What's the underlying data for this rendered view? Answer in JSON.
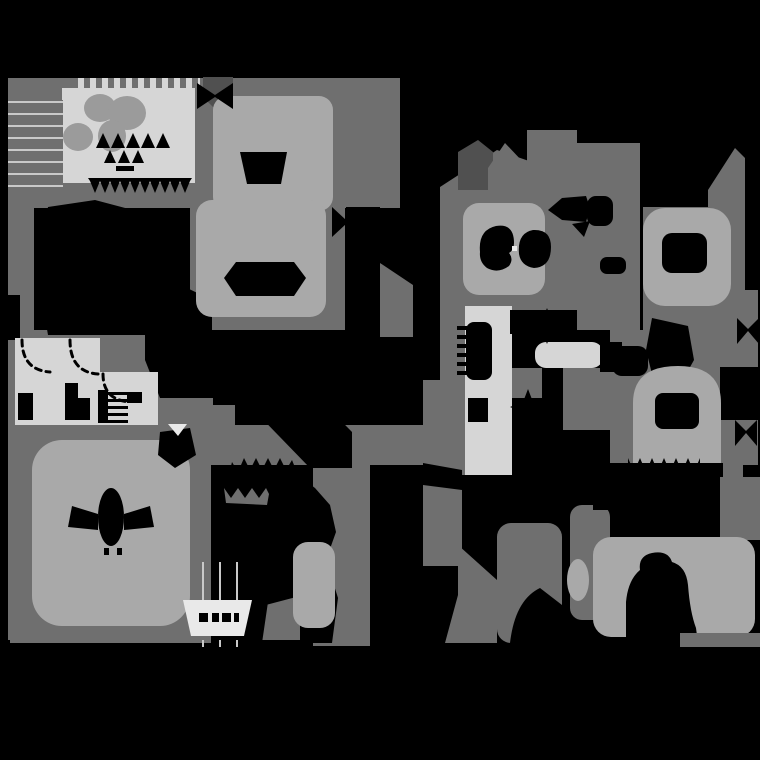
{
  "meta": {
    "description": "grayscale-terrain-map",
    "width": 760,
    "height": 760
  },
  "palette": {
    "black": "#000000",
    "dark": "#505050",
    "mid": "#6f6f6f",
    "mid2": "#9b9b9b",
    "light": "#a9a9a9",
    "room": "#d6d6d6",
    "white": "#e9e9e9",
    "line": "#c9c9c9",
    "none": "none"
  },
  "shapes": [
    {
      "n": "tl-backdrop",
      "t": "rect",
      "f": "mid",
      "x": 8,
      "y": 78,
      "w": 204,
      "h": 130
    },
    {
      "n": "left-column",
      "t": "rect",
      "f": "mid",
      "x": 8,
      "y": 95,
      "w": 26,
      "h": 545
    },
    {
      "n": "rooms-backdrop",
      "t": "rect",
      "f": "mid",
      "x": 8,
      "y": 330,
      "w": 205,
      "h": 100
    },
    {
      "n": "wedge-under-rooms",
      "t": "rect",
      "f": "mid",
      "x": 195,
      "y": 405,
      "w": 40,
      "h": 25
    },
    {
      "n": "bl-backdrop",
      "t": "rect",
      "f": "mid",
      "x": 10,
      "y": 425,
      "w": 201,
      "h": 218
    },
    {
      "n": "topcenter-backdrop",
      "t": "rect",
      "f": "mid",
      "x": 190,
      "y": 78,
      "w": 155,
      "h": 252
    },
    {
      "n": "topcenter-right",
      "t": "rect",
      "f": "mid",
      "x": 345,
      "y": 78,
      "w": 55,
      "h": 130
    },
    {
      "n": "right-wedge",
      "t": "poly",
      "f": "mid",
      "pts": "380,263 413,285 413,337 380,337"
    },
    {
      "n": "center-band",
      "t": "rect",
      "f": "mid",
      "x": 190,
      "y": 425,
      "w": 272,
      "h": 40
    },
    {
      "n": "o-column",
      "t": "rect",
      "f": "mid",
      "x": 313,
      "y": 463,
      "w": 57,
      "h": 183
    },
    {
      "n": "rb-column",
      "t": "rect",
      "f": "mid",
      "x": 423,
      "y": 380,
      "w": 39,
      "h": 186
    },
    {
      "n": "r-angle",
      "t": "poly",
      "f": "mid",
      "pts": "458,545 497,580 497,643 445,643 458,595"
    },
    {
      "n": "gg2-blob",
      "t": "rect",
      "f": "mid",
      "x": 497,
      "y": 523,
      "w": 65,
      "h": 120,
      "rx": 14
    },
    {
      "n": "s-backdrop",
      "t": "poly",
      "f": "mid",
      "pts": "440,187 497,150 555,170 555,310 440,310"
    },
    {
      "n": "col-a",
      "t": "rect",
      "f": "mid",
      "x": 527,
      "y": 130,
      "w": 50,
      "h": 180
    },
    {
      "n": "col-b",
      "t": "rect",
      "f": "mid",
      "x": 577,
      "y": 143,
      "w": 63,
      "h": 187
    },
    {
      "n": "w-backdrop",
      "t": "poly",
      "f": "mid",
      "pts": "735,148 745,158 745,330 643,330 643,207 708,207 708,190"
    },
    {
      "n": "right-edge-band",
      "t": "rect",
      "f": "mid",
      "x": 710,
      "y": 290,
      "w": 48,
      "h": 175
    },
    {
      "n": "y-left-column",
      "t": "rect",
      "f": "mid",
      "x": 440,
      "y": 310,
      "w": 25,
      "h": 165
    },
    {
      "n": "y-mid-patch",
      "t": "rect",
      "f": "mid",
      "x": 512,
      "y": 368,
      "w": 30,
      "h": 30
    },
    {
      "n": "y-right-patch",
      "t": "rect",
      "f": "mid",
      "x": 563,
      "y": 368,
      "w": 47,
      "h": 62
    },
    {
      "n": "bell-backdrop",
      "t": "rect",
      "f": "mid",
      "x": 610,
      "y": 330,
      "w": 133,
      "h": 150
    },
    {
      "n": "between-legs-wedge",
      "t": "poly",
      "f": "mid",
      "pts": "262,606 300,596 300,640 262,640"
    },
    {
      "n": "cc-column",
      "t": "rect",
      "f": "mid",
      "x": 570,
      "y": 505,
      "w": 40,
      "h": 115,
      "rx": 12
    },
    {
      "n": "dark-wedge",
      "t": "poly",
      "f": "dark",
      "pts": "203,77 233,77 233,97 218,112 203,97"
    },
    {
      "n": "dark-house",
      "t": "poly",
      "f": "dark",
      "pts": "458,152 478,140 493,152 493,190 458,190"
    },
    {
      "n": "gray-house",
      "t": "poly",
      "f": "mid",
      "pts": "488,207 488,168 505,143 523,162 523,207"
    },
    {
      "n": "comb-strip",
      "t": "rect",
      "f": "pattern:comb",
      "x": 75,
      "y": 78,
      "w": 125,
      "h": 17
    },
    {
      "n": "light-rect",
      "t": "rect",
      "f": "room",
      "x": 62,
      "y": 88,
      "w": 133,
      "h": 95
    },
    {
      "n": "stripes-panel",
      "t": "rect",
      "f": "pattern:stripes",
      "x": 8,
      "y": 100,
      "w": 55,
      "h": 95
    },
    {
      "n": "flower-1",
      "t": "ell",
      "f": "mid2",
      "cx": 100,
      "cy": 108,
      "rx": 16,
      "ry": 14
    },
    {
      "n": "flower-2",
      "t": "ell",
      "f": "mid2",
      "cx": 127,
      "cy": 113,
      "rx": 19,
      "ry": 17
    },
    {
      "n": "flower-3",
      "t": "ell",
      "f": "mid2",
      "cx": 112,
      "cy": 136,
      "rx": 14,
      "ry": 16
    },
    {
      "n": "flower-4",
      "t": "ell",
      "f": "mid2",
      "cx": 78,
      "cy": 137,
      "rx": 15,
      "ry": 14
    },
    {
      "n": "glyph-peak-1",
      "t": "poly",
      "f": "black",
      "pts": "96,148 103,133 110,148"
    },
    {
      "n": "glyph-peak-2",
      "t": "poly",
      "f": "black",
      "pts": "111,148 118,133 125,148"
    },
    {
      "n": "glyph-peak-3",
      "t": "poly",
      "f": "black",
      "pts": "126,148 133,133 140,148"
    },
    {
      "n": "glyph-peak-4",
      "t": "poly",
      "f": "black",
      "pts": "141,148 148,133 155,148"
    },
    {
      "n": "glyph-peak-5",
      "t": "poly",
      "f": "black",
      "pts": "156,148 163,133 170,148"
    },
    {
      "n": "glyph-peak-6",
      "t": "poly",
      "f": "black",
      "pts": "104,163 110,150 116,163"
    },
    {
      "n": "glyph-peak-7",
      "t": "poly",
      "f": "black",
      "pts": "118,163 124,150 130,163"
    },
    {
      "n": "glyph-peak-8",
      "t": "poly",
      "f": "black",
      "pts": "132,163 138,150 144,163"
    },
    {
      "n": "glyph-base",
      "t": "rect",
      "f": "black",
      "x": 116,
      "y": 166,
      "w": 18,
      "h": 5
    },
    {
      "n": "rect-teeth",
      "t": "path",
      "f": "black",
      "d": "M88,178 L192,178 L190,181 L185,193 L180,181 L175,193 L170,181 L165,193 L160,181 L155,193 L150,181 L145,193 L140,181 L135,193 L130,181 L125,193 L120,181 L115,193 L110,181 L105,193 L100,181 L95,193 L90,181 Z"
    },
    {
      "n": "edge-notch-black",
      "t": "rect",
      "f": "black",
      "x": 0,
      "y": 295,
      "w": 20,
      "h": 45
    },
    {
      "n": "black-blob-left",
      "t": "poly",
      "f": "black",
      "pts": "48,207 95,200 140,212 158,240 160,275 212,300 212,335 48,335 36,265"
    },
    {
      "n": "black-wedge-mid",
      "t": "poly",
      "f": "black",
      "pts": "145,330 213,330 213,398 160,398 145,360"
    },
    {
      "n": "diag-band",
      "t": "poly",
      "f": "black",
      "pts": "213,330 252,330 352,432 352,468 310,468 213,368"
    },
    {
      "n": "room-1",
      "t": "rect",
      "f": "room",
      "x": 15,
      "y": 338,
      "w": 82,
      "h": 87
    },
    {
      "n": "room-conn",
      "t": "rect",
      "f": "room",
      "x": 60,
      "y": 338,
      "w": 40,
      "h": 87
    },
    {
      "n": "room-2",
      "t": "rect",
      "f": "room",
      "x": 100,
      "y": 372,
      "w": 58,
      "h": 53
    },
    {
      "n": "door-arc-1",
      "t": "path",
      "f": "none",
      "sk": "black",
      "sw": 3,
      "da": "6,5",
      "d": "M22,340 Q22,370 50,372"
    },
    {
      "n": "door-arc-2",
      "t": "path",
      "f": "none",
      "sk": "black",
      "sw": 3,
      "da": "6,5",
      "d": "M70,340 Q70,372 98,374"
    },
    {
      "n": "door-arc-3",
      "t": "path",
      "f": "none",
      "sk": "black",
      "sw": 3,
      "da": "6,5",
      "d": "M103,374 Q103,400 130,402"
    },
    {
      "n": "room-black-1",
      "t": "rect",
      "f": "black",
      "x": 18,
      "y": 393,
      "w": 15,
      "h": 27
    },
    {
      "n": "room-black-2",
      "t": "rect",
      "f": "black",
      "x": 65,
      "y": 383,
      "w": 13,
      "h": 37
    },
    {
      "n": "room-black-3",
      "t": "rect",
      "f": "black",
      "x": 78,
      "y": 398,
      "w": 12,
      "h": 22
    },
    {
      "n": "room-ladder-bar",
      "t": "rect",
      "f": "black",
      "x": 98,
      "y": 390,
      "w": 10,
      "h": 33
    },
    {
      "n": "ladder-tick-1",
      "t": "rect",
      "f": "black",
      "x": 108,
      "y": 392,
      "w": 20,
      "h": 3
    },
    {
      "n": "ladder-tick-2",
      "t": "rect",
      "f": "black",
      "x": 108,
      "y": 399,
      "w": 20,
      "h": 3
    },
    {
      "n": "ladder-tick-3",
      "t": "rect",
      "f": "black",
      "x": 108,
      "y": 406,
      "w": 20,
      "h": 3
    },
    {
      "n": "ladder-tick-4",
      "t": "rect",
      "f": "black",
      "x": 108,
      "y": 413,
      "w": 20,
      "h": 3
    },
    {
      "n": "ladder-tick-5",
      "t": "rect",
      "f": "black",
      "x": 108,
      "y": 420,
      "w": 20,
      "h": 3
    },
    {
      "n": "room-black-4",
      "t": "rect",
      "f": "black",
      "x": 127,
      "y": 392,
      "w": 15,
      "h": 11
    },
    {
      "n": "e-blob-top",
      "t": "rect",
      "f": "light",
      "x": 213,
      "y": 96,
      "w": 120,
      "h": 115,
      "rx": 14
    },
    {
      "n": "e-blob-bottom",
      "t": "rect",
      "f": "light",
      "x": 196,
      "y": 200,
      "w": 130,
      "h": 117,
      "rx": 16
    },
    {
      "n": "cup-hole",
      "t": "poly",
      "f": "black",
      "pts": "240,152 287,152 281,184 247,184"
    },
    {
      "n": "hex-hole",
      "t": "poly",
      "f": "black",
      "pts": "224,278 236,262 294,262 306,278 294,296 236,296"
    },
    {
      "n": "bowtie-1",
      "t": "poly",
      "f": "black",
      "pts": "197,83 215,95 233,83 233,109 215,97 197,109"
    },
    {
      "n": "black-patch-right",
      "t": "rect",
      "f": "black",
      "x": 346,
      "y": 207,
      "w": 34,
      "h": 36
    },
    {
      "n": "bowtie-2",
      "t": "poly",
      "f": "black",
      "pts": "332,207 346,220 360,207 360,237 346,224 332,237"
    },
    {
      "n": "j-blob",
      "t": "rect",
      "f": "light",
      "x": 32,
      "y": 440,
      "w": 158,
      "h": 186,
      "rx": 30
    },
    {
      "n": "bug-body",
      "t": "ell",
      "f": "black",
      "cx": 111,
      "cy": 517,
      "rx": 13,
      "ry": 29
    },
    {
      "n": "bug-wing-left",
      "t": "poly",
      "f": "black",
      "pts": "72,506 98,514 98,530 68,527"
    },
    {
      "n": "bug-wing-right",
      "t": "poly",
      "f": "black",
      "pts": "124,514 150,506 154,527 124,530"
    },
    {
      "n": "bug-mark-1",
      "t": "rect",
      "f": "black",
      "x": 104,
      "y": 548,
      "w": 5,
      "h": 7
    },
    {
      "n": "bug-mark-2",
      "t": "rect",
      "f": "black",
      "x": 117,
      "y": 548,
      "w": 5,
      "h": 7
    },
    {
      "n": "black-blob-tr",
      "t": "poly",
      "f": "black",
      "pts": "160,432 190,428 196,455 175,468 158,455"
    },
    {
      "n": "white-tri",
      "t": "poly",
      "f": "white",
      "pts": "168,424 187,424 178,436"
    },
    {
      "n": "monster",
      "t": "path",
      "f": "black",
      "d": "M228,478 L232,462 L238,472 L244,458 L250,470 L256,458 L262,470 L268,458 L274,470 L280,458 L286,470 L292,460 L298,475 L315,488 L330,505 L336,532 L326,560 L338,598 L332,643 L300,643 L306,604 L288,572 L268,602 L262,643 L228,643 L234,592 L220,560 L224,522 L212,505 L218,488 Z"
    },
    {
      "n": "monster-squiggle",
      "t": "path",
      "f": "mid",
      "d": "M224,488 L231,498 L238,488 L245,498 L252,488 L259,498 L266,488 L269,494 L267,505 L226,503 Z"
    },
    {
      "n": "n-blob",
      "t": "rect",
      "f": "light",
      "x": 293,
      "y": 542,
      "w": 42,
      "h": 86,
      "rx": 15
    },
    {
      "n": "table-line-1",
      "t": "rect",
      "f": "line",
      "x": 202,
      "y": 562,
      "w": 2,
      "h": 38
    },
    {
      "n": "table-line-2",
      "t": "rect",
      "f": "line",
      "x": 219,
      "y": 562,
      "w": 2,
      "h": 38
    },
    {
      "n": "table-line-3",
      "t": "rect",
      "f": "line",
      "x": 236,
      "y": 562,
      "w": 2,
      "h": 38
    },
    {
      "n": "table-line-4",
      "t": "rect",
      "f": "line",
      "x": 202,
      "y": 640,
      "w": 2,
      "h": 22
    },
    {
      "n": "table-line-5",
      "t": "rect",
      "f": "line",
      "x": 219,
      "y": 640,
      "w": 2,
      "h": 22
    },
    {
      "n": "table-line-6",
      "t": "rect",
      "f": "line",
      "x": 236,
      "y": 640,
      "w": 2,
      "h": 22
    },
    {
      "n": "trapezoid",
      "t": "poly",
      "f": "white",
      "pts": "183,600 252,600 244,636 191,636"
    },
    {
      "n": "trap-glyph-1",
      "t": "rect",
      "f": "black",
      "x": 199,
      "y": 613,
      "w": 9,
      "h": 9
    },
    {
      "n": "trap-glyph-2",
      "t": "rect",
      "f": "black",
      "x": 212,
      "y": 613,
      "w": 7,
      "h": 9
    },
    {
      "n": "trap-glyph-3",
      "t": "rect",
      "f": "black",
      "x": 222,
      "y": 613,
      "w": 9,
      "h": 9
    },
    {
      "n": "trap-glyph-4",
      "t": "rect",
      "f": "black",
      "x": 234,
      "y": 613,
      "w": 5,
      "h": 9
    },
    {
      "n": "s-blob",
      "t": "rect",
      "f": "light",
      "x": 463,
      "y": 203,
      "w": 82,
      "h": 92,
      "rx": 16
    },
    {
      "n": "comma-left",
      "t": "path",
      "f": "black",
      "d": "M480,252 Q478,230 496,226 Q514,223 514,243 Q514,250 509,253 Q514,259 509,266 Q498,274 487,268 Q479,262 480,252 Z"
    },
    {
      "n": "comma-right",
      "t": "path",
      "f": "black",
      "d": "M519,254 Q517,233 533,230 Q551,229 551,247 Q551,267 534,268 Q521,266 519,254 Z"
    },
    {
      "n": "white-speck",
      "t": "rect",
      "f": "white",
      "x": 512,
      "y": 246,
      "w": 5,
      "h": 5
    },
    {
      "n": "arrow-blob",
      "t": "path",
      "f": "black",
      "d": "M548,210 L562,198 L586,196 L590,208 L586,222 L562,220 Z"
    },
    {
      "n": "arrow-rect",
      "t": "rect",
      "f": "black",
      "x": 587,
      "y": 196,
      "w": 26,
      "h": 30,
      "rx": 9
    },
    {
      "n": "arrow-tri",
      "t": "poly",
      "f": "black",
      "pts": "572,224 590,221 584,237"
    },
    {
      "n": "small-blob",
      "t": "rect",
      "f": "black",
      "x": 600,
      "y": 257,
      "w": 26,
      "h": 17,
      "rx": 7
    },
    {
      "n": "w-blob",
      "t": "rect",
      "f": "light",
      "x": 643,
      "y": 208,
      "w": 88,
      "h": 98,
      "rx": 22
    },
    {
      "n": "w-hole",
      "t": "rect",
      "f": "black",
      "x": 662,
      "y": 233,
      "w": 45,
      "h": 40,
      "rx": 10
    },
    {
      "n": "y-band",
      "t": "rect",
      "f": "room",
      "x": 465,
      "y": 306,
      "w": 47,
      "h": 169
    },
    {
      "n": "y-hole-1",
      "t": "rect",
      "f": "black",
      "x": 466,
      "y": 322,
      "w": 26,
      "h": 58,
      "rx": 8
    },
    {
      "n": "y-tick-1",
      "t": "rect",
      "f": "black",
      "x": 457,
      "y": 326,
      "w": 10,
      "h": 4
    },
    {
      "n": "y-tick-2",
      "t": "rect",
      "f": "black",
      "x": 457,
      "y": 335,
      "w": 10,
      "h": 4
    },
    {
      "n": "y-tick-3",
      "t": "rect",
      "f": "black",
      "x": 457,
      "y": 344,
      "w": 10,
      "h": 4
    },
    {
      "n": "y-tick-4",
      "t": "rect",
      "f": "black",
      "x": 457,
      "y": 353,
      "w": 10,
      "h": 4
    },
    {
      "n": "y-tick-5",
      "t": "rect",
      "f": "black",
      "x": 457,
      "y": 362,
      "w": 10,
      "h": 4
    },
    {
      "n": "y-tick-6",
      "t": "rect",
      "f": "black",
      "x": 457,
      "y": 371,
      "w": 10,
      "h": 4
    },
    {
      "n": "y-hole-2",
      "t": "rect",
      "f": "black",
      "x": 468,
      "y": 398,
      "w": 20,
      "h": 24
    },
    {
      "n": "y-black-top",
      "t": "rect",
      "f": "black",
      "x": 510,
      "y": 310,
      "w": 15,
      "h": 24
    },
    {
      "n": "y-black-bottom",
      "t": "rect",
      "f": "black",
      "x": 516,
      "y": 437,
      "w": 47,
      "h": 34
    },
    {
      "n": "y-right-black",
      "t": "rect",
      "f": "black",
      "x": 563,
      "y": 430,
      "w": 47,
      "h": 45
    },
    {
      "n": "z-banner",
      "t": "rect",
      "f": "room",
      "x": 535,
      "y": 342,
      "w": 68,
      "h": 26,
      "rx": 11
    },
    {
      "n": "z-right-black",
      "t": "rect",
      "f": "black",
      "x": 600,
      "y": 342,
      "w": 22,
      "h": 30
    },
    {
      "n": "star-1",
      "t": "poly",
      "f": "black",
      "pts": "547,308 552,321 565,326 552,331 547,344 542,331 529,326 542,321"
    },
    {
      "n": "star-2",
      "t": "poly",
      "f": "black",
      "pts": "528,389 533,402 546,407 533,412 528,425 523,412 510,407 523,402"
    },
    {
      "n": "bell-black-1",
      "t": "rect",
      "f": "black",
      "x": 612,
      "y": 346,
      "w": 36,
      "h": 30,
      "rx": 10
    },
    {
      "n": "bell-black-2",
      "t": "poly",
      "f": "black",
      "pts": "652,318 688,326 694,360 676,392 654,382 646,350"
    },
    {
      "n": "bell-black-3",
      "t": "rect",
      "f": "black",
      "x": 720,
      "y": 367,
      "w": 40,
      "h": 53
    },
    {
      "n": "bell-blob",
      "t": "path",
      "f": "light",
      "d": "M633,463 L633,403 Q633,366 678,366 Q721,366 721,403 L721,463 Z"
    },
    {
      "n": "bell-hole",
      "t": "rect",
      "f": "black",
      "x": 655,
      "y": 393,
      "w": 44,
      "h": 36,
      "rx": 8
    },
    {
      "n": "bell-teeth",
      "t": "path",
      "f": "black",
      "d": "M628,458 L634,472 L640,458 L646,472 L652,458 L658,472 L664,458 L670,472 L676,458 L682,472 L688,458 L694,472 L700,458 L700,480 L628,480 Z"
    },
    {
      "n": "black-band-br",
      "t": "rect",
      "f": "black",
      "x": 593,
      "y": 463,
      "w": 130,
      "h": 47
    },
    {
      "n": "br-corner-patch",
      "t": "rect",
      "f": "mid",
      "x": 720,
      "y": 477,
      "w": 40,
      "h": 63
    },
    {
      "n": "dd-blob",
      "t": "rect",
      "f": "light",
      "x": 593,
      "y": 537,
      "w": 162,
      "h": 100,
      "rx": 18
    },
    {
      "n": "dd-head-hole",
      "t": "path",
      "f": "black",
      "d": "M626,643 L626,602 Q628,580 640,570 Q638,556 652,553 Q668,550 672,562 Q686,566 688,585 Q690,612 696,628 L698,643 Z"
    },
    {
      "n": "cc-light-spot",
      "t": "ell",
      "f": "light",
      "cx": 578,
      "cy": 580,
      "rx": 11,
      "ry": 21
    },
    {
      "n": "gg2-black-cut",
      "t": "path",
      "f": "black",
      "d": "M510,643 Q515,600 540,588 L562,605 L562,643 Z"
    },
    {
      "n": "bowtie-r1",
      "t": "poly",
      "f": "black",
      "pts": "737,318 748,329 759,318 759,344 748,331 737,344"
    },
    {
      "n": "bowtie-r2",
      "t": "poly",
      "f": "black",
      "pts": "735,420 746,431 757,420 757,446 746,433 735,446"
    },
    {
      "n": "rb-black-notch",
      "t": "poly",
      "f": "black",
      "pts": "423,463 462,470 462,490 423,485"
    },
    {
      "n": "bottom-black",
      "t": "rect",
      "f": "black",
      "x": 0,
      "y": 647,
      "w": 760,
      "h": 113
    },
    {
      "n": "br-strip",
      "t": "rect",
      "f": "mid",
      "x": 680,
      "y": 633,
      "w": 80,
      "h": 14
    }
  ]
}
